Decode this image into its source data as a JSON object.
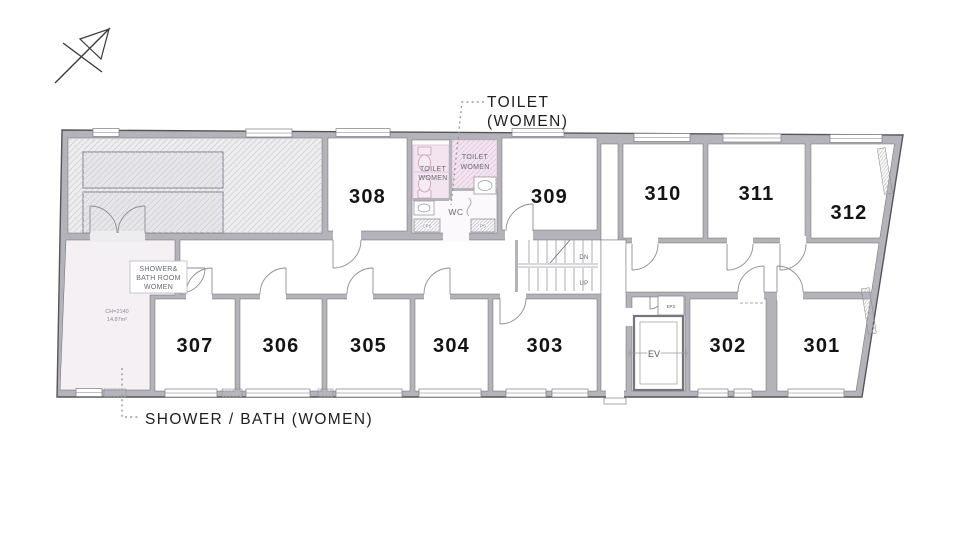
{
  "callouts": {
    "toilet": {
      "line1": "TOILET",
      "line2": "(WOMEN)"
    },
    "shower": {
      "label": "SHOWER / BATH (WOMEN)"
    }
  },
  "rooms": {
    "r301": "301",
    "r302": "302",
    "r303": "303",
    "r304": "304",
    "r305": "305",
    "r306": "306",
    "r307": "307",
    "r308": "308",
    "r309": "309",
    "r310": "310",
    "r311": "311",
    "r312": "312"
  },
  "annotations": {
    "toilet_left": {
      "line1": "TOILET",
      "line2": "WOMEN"
    },
    "toilet_right": {
      "line1": "TOILET",
      "line2": "WOMEN"
    },
    "wc": "WC",
    "shower_room": {
      "line1": "SHOWER&",
      "line2": "BATH ROOM",
      "line3": "WOMEN"
    },
    "ceiling_height": "CH=2140",
    "floor_area": "14.87m²",
    "elevator": "EV",
    "eps": "EPS",
    "cps": "CPS",
    "ps": "PS",
    "stairs_down": "DN",
    "stairs_up": "UP"
  },
  "colors": {
    "wall": "#b3b3b9",
    "wall_edge": "#55555c",
    "hatch_area_bg": "#ededef",
    "hatch_line": "#cfcfd5",
    "pink_zone": "#f3e4ef",
    "pink_line": "#e0c4d8",
    "shower_floor": "#f4f0f4",
    "room_floor": "#ffffff",
    "annotation_text": "#6a6a70",
    "leader": "#9a9aa0"
  }
}
